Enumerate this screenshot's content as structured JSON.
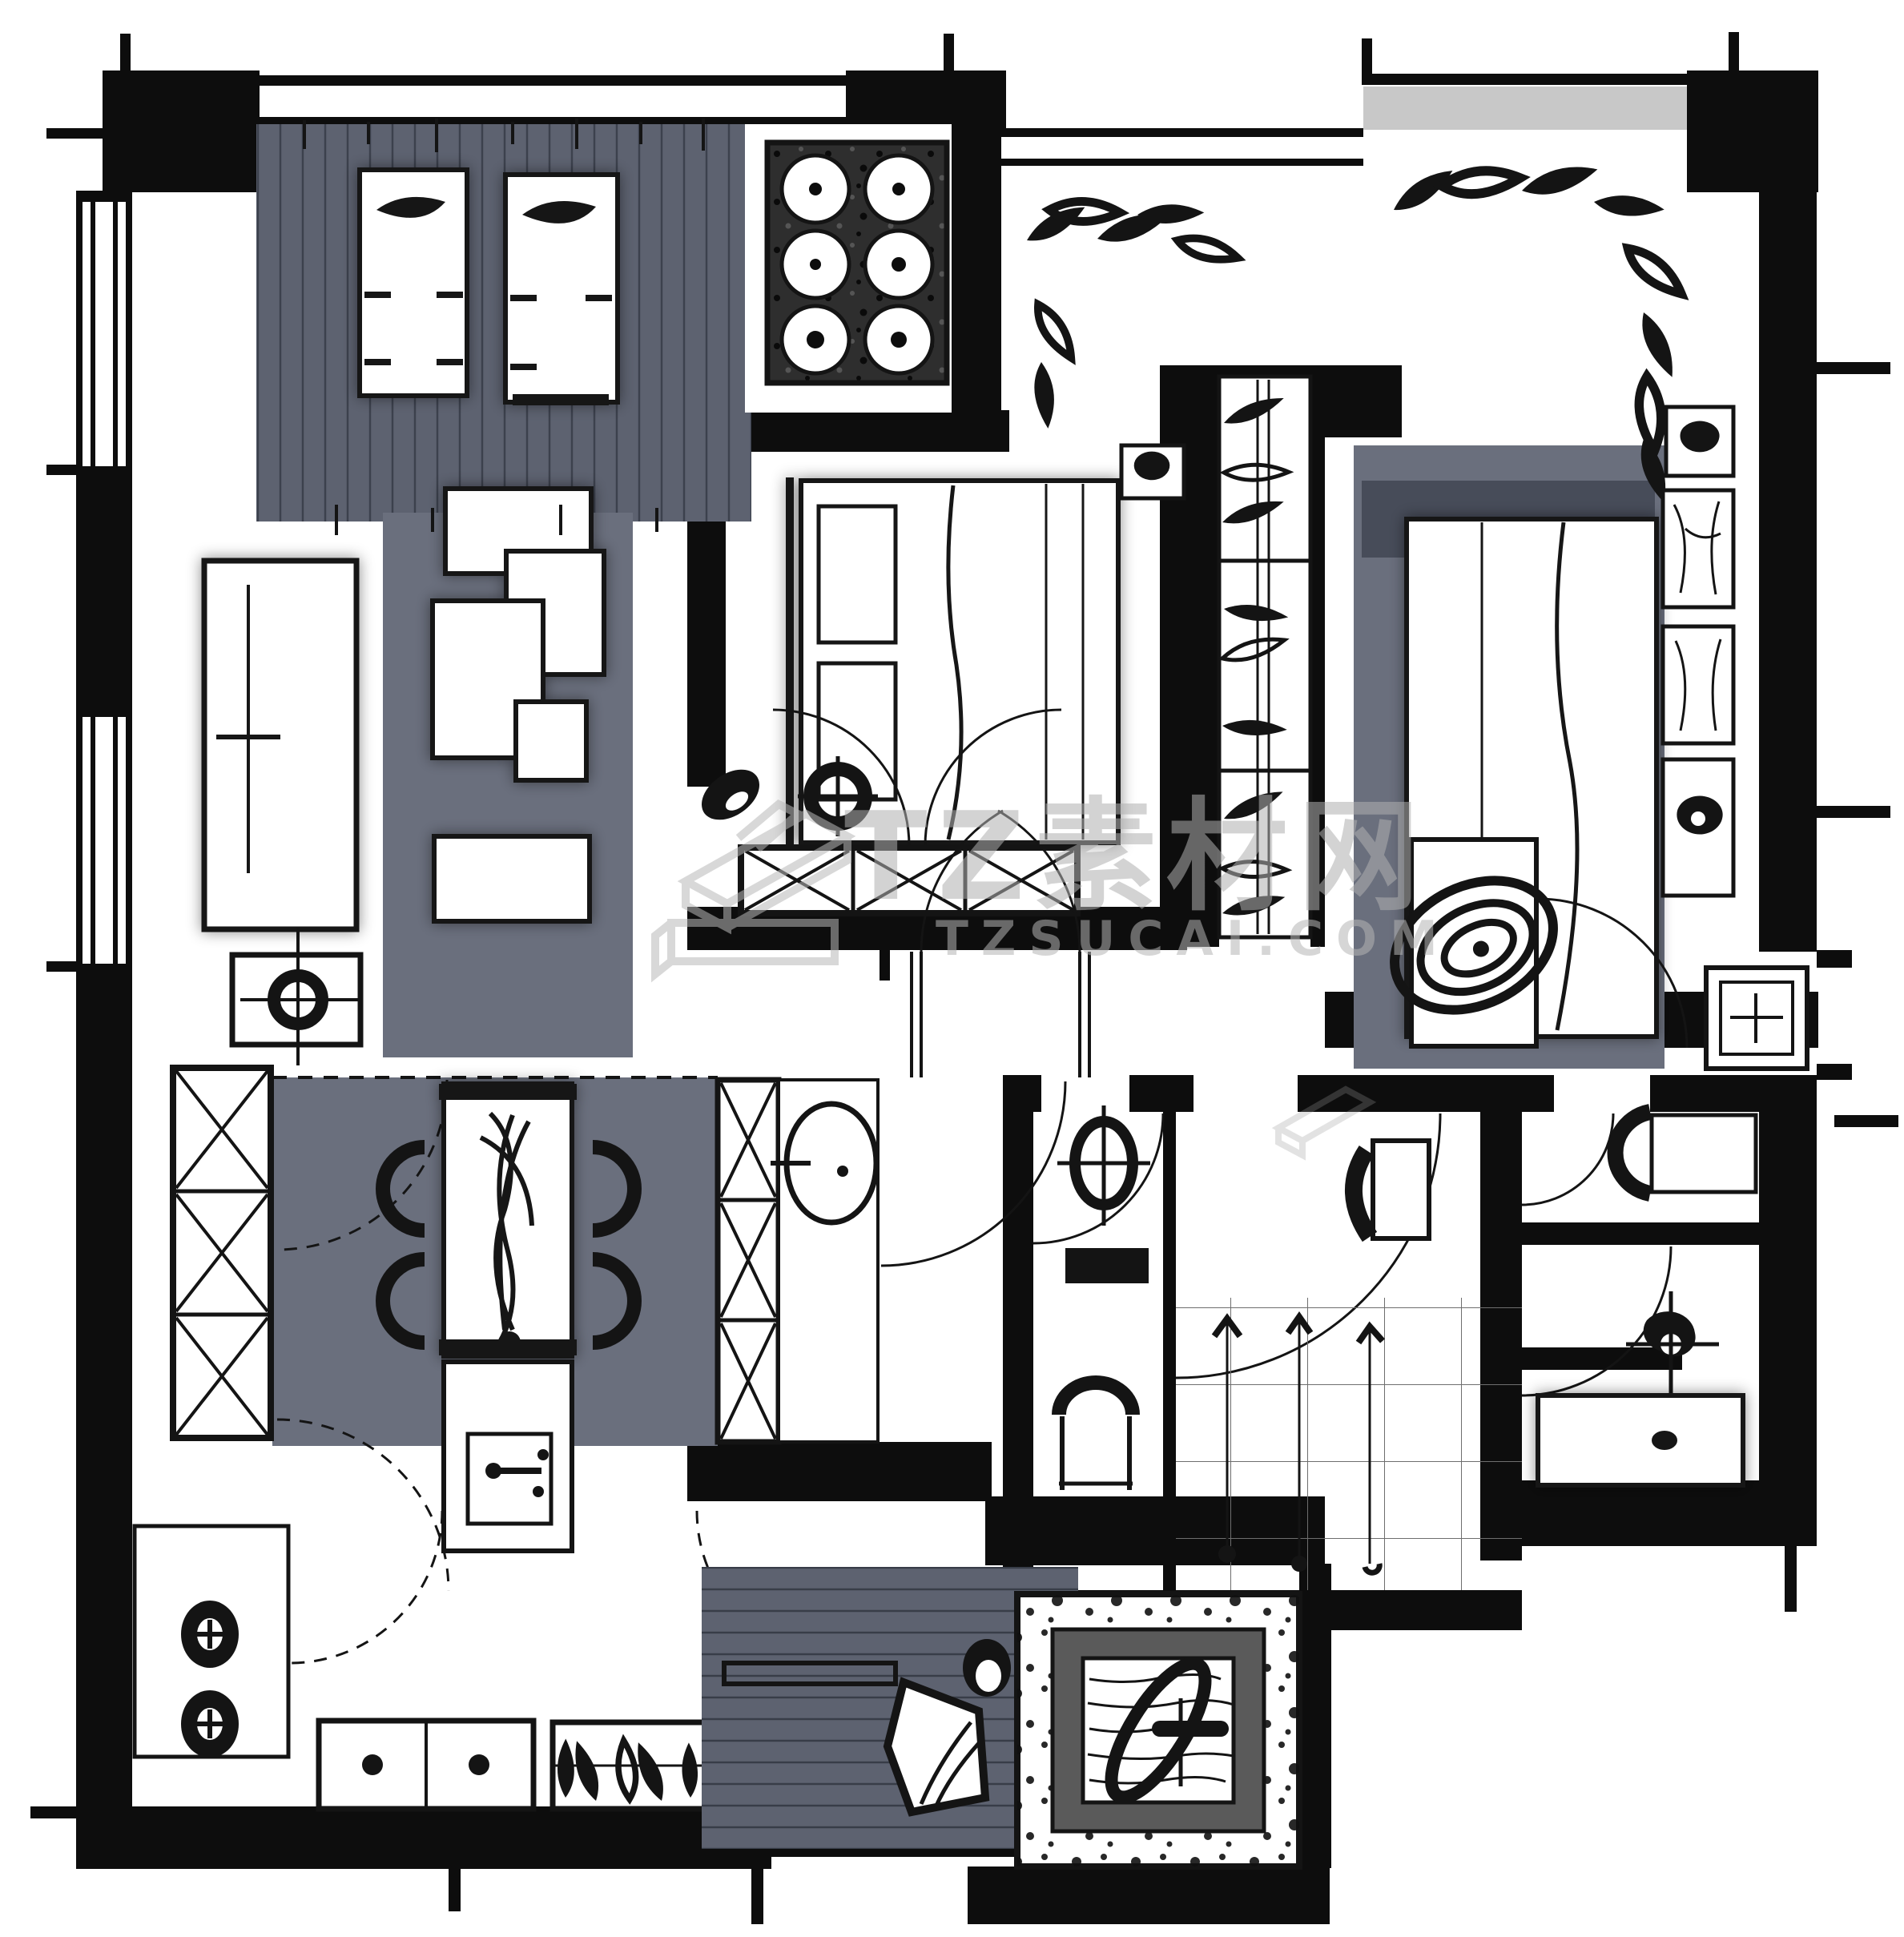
{
  "watermark": {
    "title": "TZ素材网",
    "subtitle": "TZSUCAI.COM",
    "logo": "tz-3d-box-logo"
  },
  "palette": {
    "wall_black": "#0d0d0d",
    "ink": "#141414",
    "deck_gray": "#5d6270",
    "rug_gray": "#6a6f7d",
    "headboard_gray": "#474c59",
    "stipple_dark": "#2e2e2e",
    "spa_frame_gray": "#5a5a5a",
    "watermark_gray": "#b9b9b9",
    "paper_white": "#ffffff"
  },
  "elements": [
    "balcony-deck",
    "lounge-chair",
    "outdoor-dining-table",
    "laundry-balcony",
    "living-room-rug",
    "modular-sofa",
    "coffee-table",
    "tv-cabinet",
    "side-lamp-table",
    "bedroom-bed",
    "pillow",
    "nightstand",
    "table-lamp",
    "slippers",
    "round-stool",
    "dresser-cabinet",
    "walk-in-wardrobe",
    "hanging-clothes",
    "plant-leaves",
    "dining-rug",
    "dining-table",
    "dining-chair",
    "flower-centerpiece",
    "shoe-cabinet",
    "kitchen-island",
    "kitchen-tall-cabinets",
    "round-basin",
    "door-swing",
    "toilet",
    "wall-shelf",
    "bathroom-chair",
    "dressing-desk",
    "desk-chair",
    "clothes-hooks",
    "tile-floor",
    "urinal-basin",
    "bathtub",
    "vanity-basin",
    "swirl-rug",
    "spa-tub",
    "pebble-border",
    "wood-deck",
    "deck-bench",
    "deck-lounger",
    "pouf",
    "kitchen-counter",
    "burner-knobs",
    "base-cabinet",
    "planter-box",
    "window",
    "wall",
    "dimension-tick"
  ]
}
